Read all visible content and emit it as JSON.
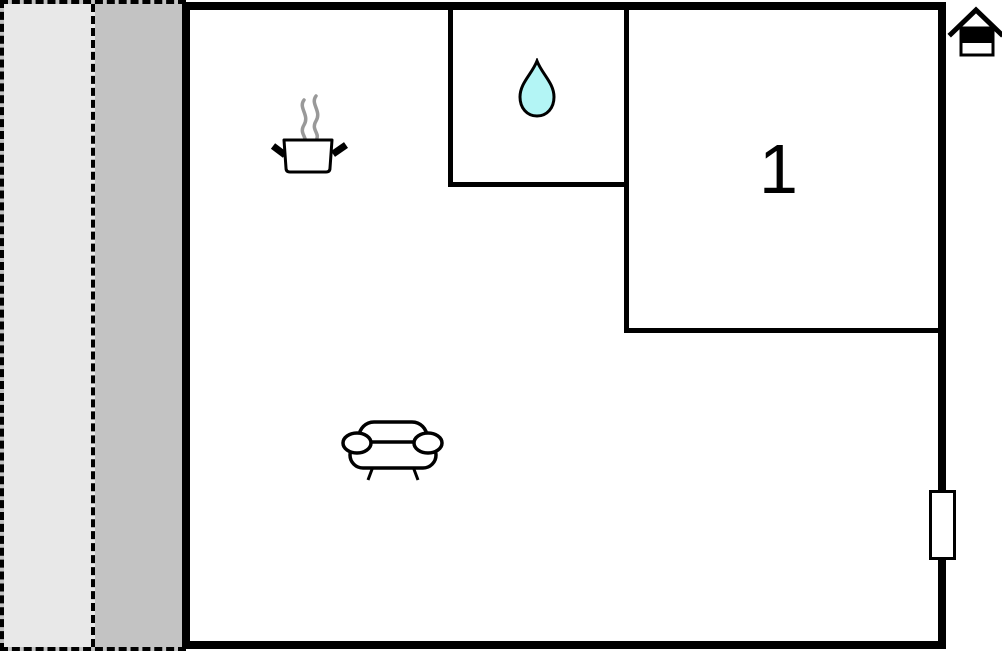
{
  "plan": {
    "type": "floor-plan",
    "rooms": {
      "bedroom": {
        "label": "1",
        "features": [
          "numbered room"
        ]
      },
      "bathroom": {
        "icon": "water-drop-icon"
      },
      "kitchen_area": {
        "icon": "cooking-pot-icon"
      },
      "living_area": {
        "icon": "sofa-icon"
      },
      "terrace": {
        "zones": [
          "light-strip",
          "dark-strip"
        ],
        "outline": "dashed"
      }
    },
    "markers": {
      "entrance": "house-icon",
      "window": "window-marker-on-right-wall"
    }
  },
  "colors": {
    "wall": "#000000",
    "background": "#ffffff",
    "terrace_light": "#e8e8e8",
    "terrace_dark": "#c3c3c3",
    "water_drop_fill": "#b3f5f5",
    "steam": "#999999"
  }
}
